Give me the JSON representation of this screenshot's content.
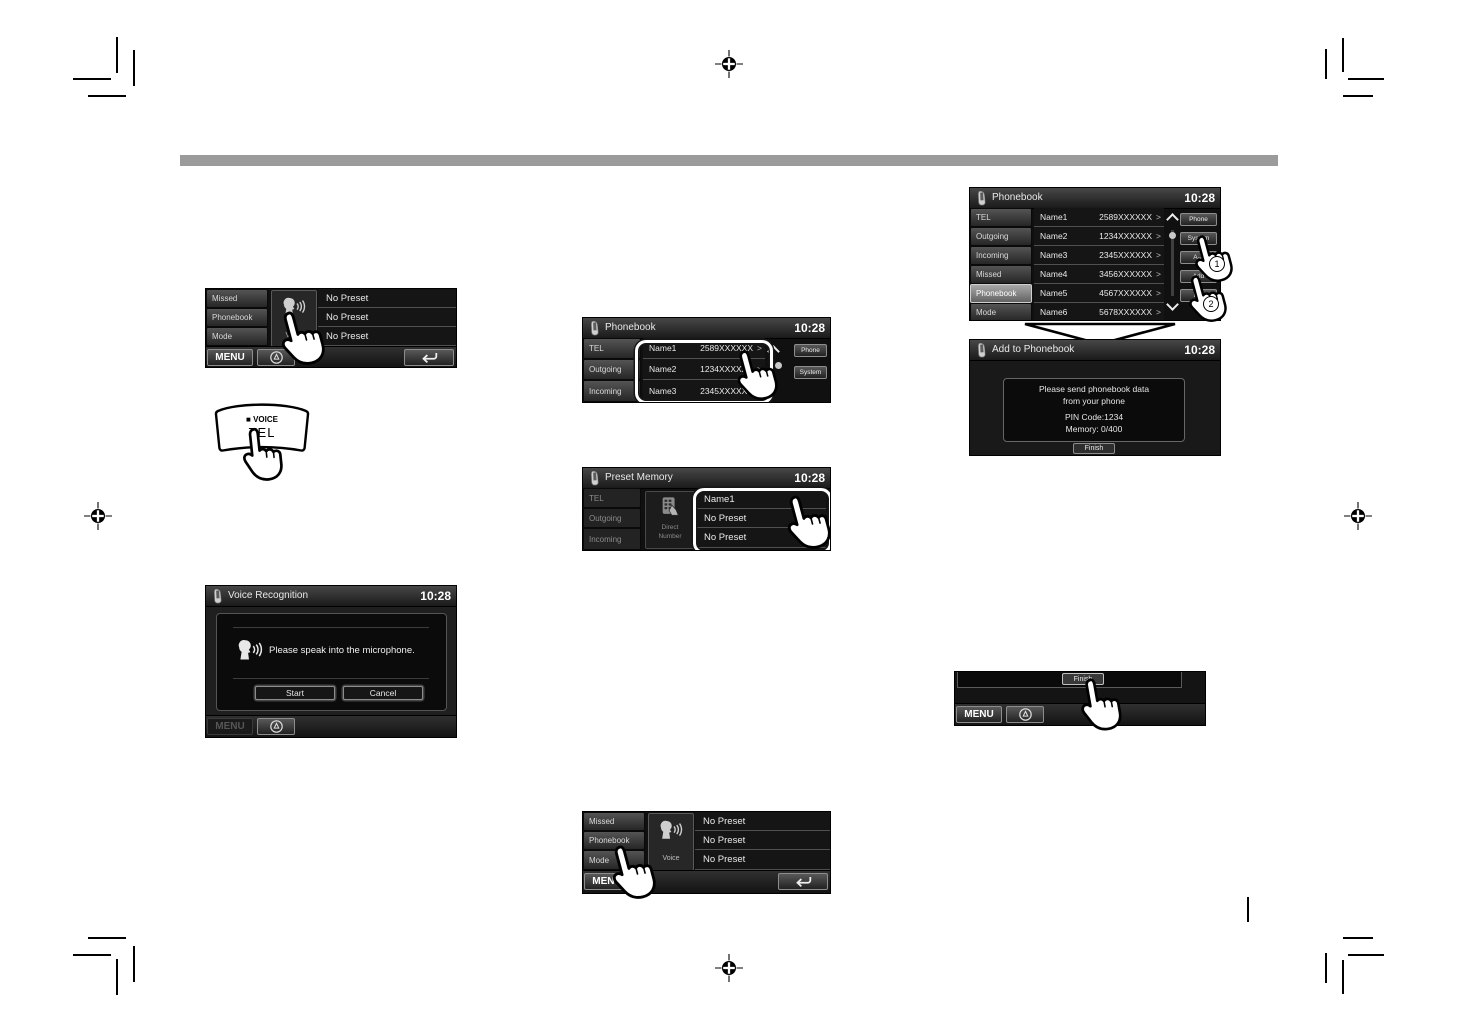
{
  "clock": "10:28",
  "colors": {
    "page_bg": "#ffffff",
    "band_gray": "#9b9b9b",
    "screen_bg": "#101010"
  },
  "phone_menu": {
    "items": [
      "Missed",
      "Phonebook",
      "Mode"
    ],
    "voice_label": "Voice",
    "presets": [
      "No Preset",
      "No Preset",
      "No Preset"
    ],
    "menu": "MENU"
  },
  "voice_tel_key": {
    "top_label": "■ VOICE",
    "main_label": "TEL"
  },
  "voice_recognition": {
    "title": "Voice Recognition",
    "prompt": "Please speak into the microphone.",
    "start": "Start",
    "cancel": "Cancel",
    "menu": "MENU"
  },
  "phonebook_preview": {
    "title": "Phonebook",
    "tabs": [
      "TEL",
      "Outgoing",
      "Incoming"
    ],
    "entries": [
      {
        "name": "Name1",
        "number": "2589XXXXXX"
      },
      {
        "name": "Name2",
        "number": "1234XXXXXX"
      },
      {
        "name": "Name3",
        "number": "2345XXXXXX"
      }
    ],
    "side_buttons": [
      "Phone",
      "System"
    ],
    "arrow": ">"
  },
  "preset_memory": {
    "title": "Preset Memory",
    "tabs": [
      "TEL",
      "Outgoing",
      "Incoming"
    ],
    "direct_number_line1": "Direct",
    "direct_number_line2": "Number",
    "slots": [
      "Name1",
      "No Preset",
      "No Preset"
    ]
  },
  "phonebook_full": {
    "title": "Phonebook",
    "tabs": [
      "TEL",
      "Outgoing",
      "Incoming",
      "Missed",
      "Phonebook",
      "Mode"
    ],
    "entries": [
      {
        "name": "Name1",
        "number": "2589XXXXXX"
      },
      {
        "name": "Name2",
        "number": "1234XXXXXX"
      },
      {
        "name": "Name3",
        "number": "2345XXXXXX"
      },
      {
        "name": "Name4",
        "number": "3456XXXXXX"
      },
      {
        "name": "Name5",
        "number": "4567XXXXXX"
      },
      {
        "name": "Name6",
        "number": "5678XXXXXX"
      }
    ],
    "side_buttons": [
      "Phone",
      "System",
      "A-Z",
      "Add",
      "Del"
    ],
    "arrow": ">",
    "steps": [
      "1",
      "2"
    ]
  },
  "add_to_phonebook": {
    "title": "Add to Phonebook",
    "message_lines": [
      "Please send phonebook data",
      "from your phone",
      "PIN Code:1234",
      "Memory: 0/400"
    ],
    "finish": "Finish"
  },
  "finish_bar": {
    "finish": "Finish",
    "menu": "MENU"
  }
}
